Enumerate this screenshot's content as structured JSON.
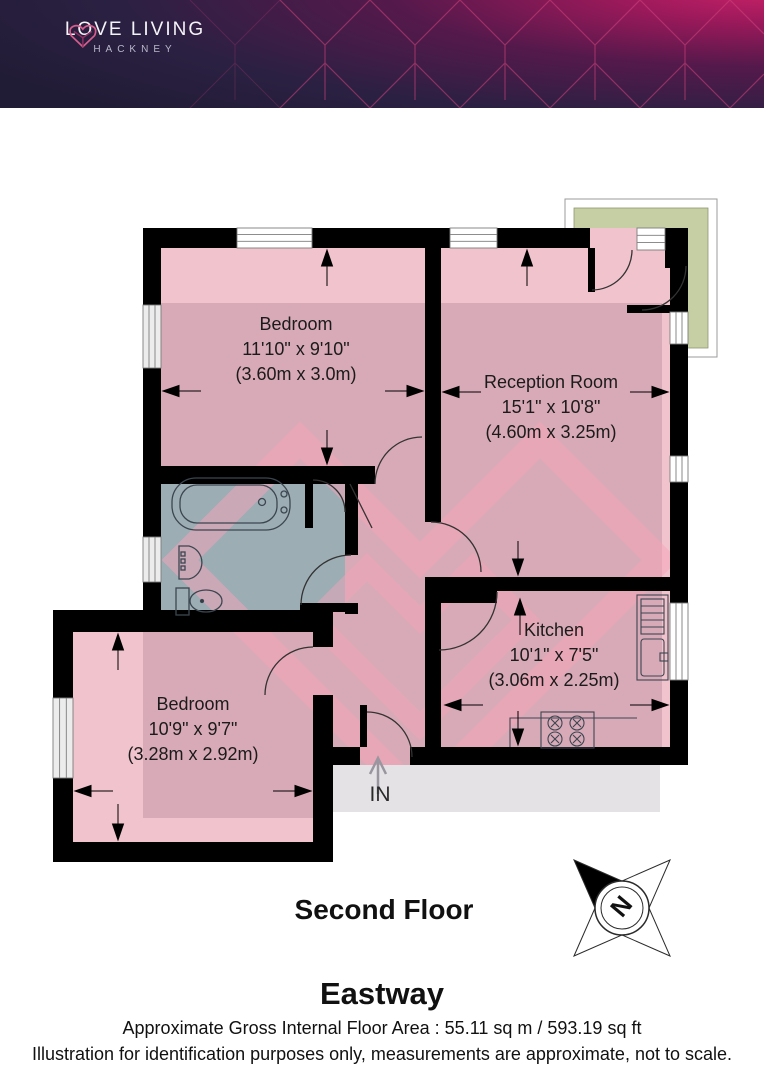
{
  "header": {
    "brand_line1": "LOVE LIVING",
    "brand_line2": "HACKNEY"
  },
  "plan": {
    "rooms": [
      {
        "name": "Bedroom",
        "size_imperial": "11'10\" x 9'10\"",
        "size_metric": "(3.60m x 3.0m)"
      },
      {
        "name": "Reception Room",
        "size_imperial": "15'1\" x 10'8\"",
        "size_metric": "(4.60m x 3.25m)"
      },
      {
        "name": "Kitchen",
        "size_imperial": "10'1\" x 7'5\"",
        "size_metric": "(3.06m x 2.25m)"
      },
      {
        "name": "Bedroom",
        "size_imperial": "10'9\" x 9'7\"",
        "size_metric": "(3.28m x 2.92m)"
      }
    ],
    "entrance_label": "IN",
    "compass_label": "N"
  },
  "footer": {
    "floor_label": "Second Floor",
    "property_name": "Eastway",
    "area_line": "Approximate Gross Internal Floor Area : 55.11 sq m / 593.19 sq ft",
    "disclaimer": "Illustration for identification purposes only, measurements are approximate, not to scale."
  },
  "colors": {
    "brand_navy": "#211c36",
    "brand_magenta": "#c41d63",
    "room_fill": "#f1c3cd",
    "bathroom_fill": "#abc6ca",
    "balcony_fill": "#c6cfa4",
    "landing_fill": "#e4e2e5",
    "wall": "#000000"
  }
}
